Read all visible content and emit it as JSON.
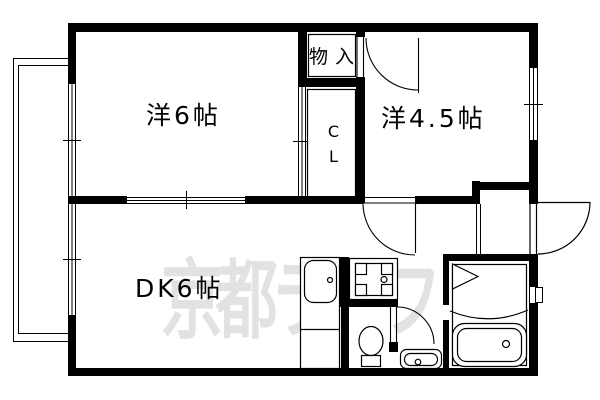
{
  "plan": {
    "rooms": {
      "western6": "洋6帖",
      "western45": "洋4.5帖",
      "dk": "DK6帖",
      "storage": "物入",
      "closet": "CL"
    },
    "watermark": {
      "text": "京都ライフ",
      "color": "#e2e2e2"
    },
    "colors": {
      "line": "#000000",
      "background": "#ffffff"
    },
    "fixtures": [
      "balcony",
      "kitchen-sink",
      "gas-stove",
      "toilet",
      "washbasin",
      "bathtub",
      "entrance-door"
    ]
  }
}
